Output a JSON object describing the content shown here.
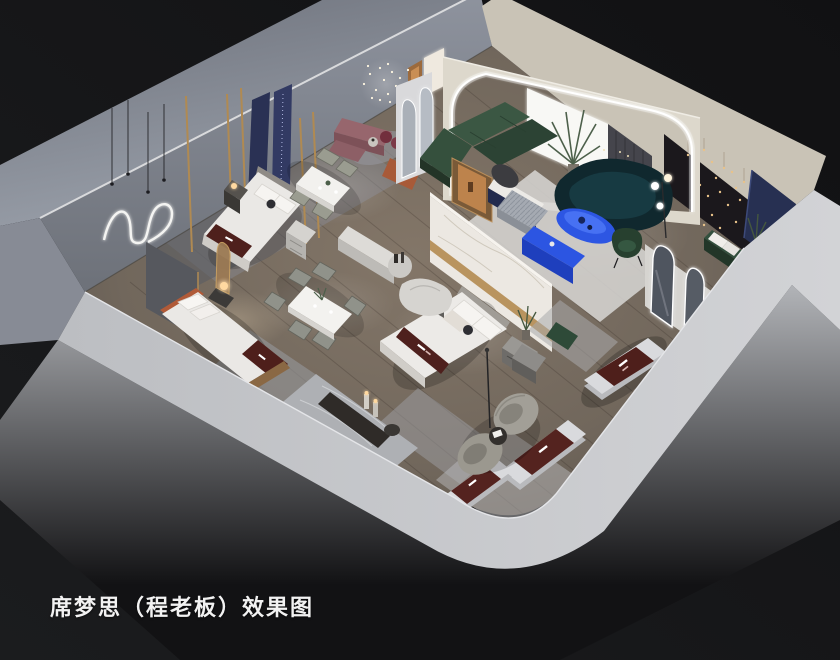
{
  "caption": {
    "text": "席梦思（程老板）效果图"
  },
  "scene": {
    "type": "3d-isometric-interior-rendering",
    "subject": "Simmons mattress showroom cutaway floor plan, viewed from above at an angle on a black backdrop",
    "areas": [
      "bedroom-display-left",
      "bedroom-display-upper",
      "dining-set-upper",
      "dining-set-lower",
      "living-lounge-with-curved-sofa",
      "master-bed-display-with-marble-wall",
      "mattress-display-platforms",
      "dressing-arch-mirrors",
      "entry-led-arch",
      "mauve-lounge-corner",
      "fairy-light-feature-wall"
    ],
    "palette": {
      "background": "#141416",
      "outer_wall": "#c5c7ca",
      "apron": "#8c9099",
      "back_wall_blue_gray": "#80858f",
      "cream_wall": "#ddd8cc",
      "floor_wood": "#7d7164",
      "mattress_maroon": "#4e1f1b",
      "accent_blue": "#2c55e2",
      "sofa_green": "#3b5743",
      "sofa_teal": "#143137",
      "gold_trim": "#b08a52",
      "led_white": "#ffffff",
      "navy_panel": "#273052",
      "glow_warm": "#ffd9a0"
    }
  }
}
